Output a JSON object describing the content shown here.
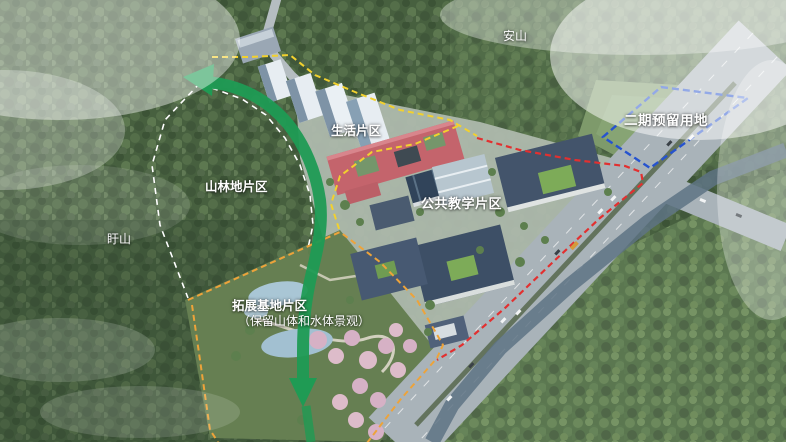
{
  "title": "校园规划鸟瞰图",
  "labels": {
    "anshan": "安山",
    "xushan": "盱山",
    "phase2": "二期预留用地",
    "living": "生活片区",
    "forest_zone": "山林地片区",
    "teaching": "公共教学片区",
    "expansion": "拓展基地片区",
    "expansion_note": "（保留山体和水体景观）"
  },
  "colors": {
    "phase2_boundary": "#2653cf",
    "campus_boundary": "#e23030",
    "zone_divider_yellow": "#f2d12e",
    "expansion_boundary": "#eda33a",
    "forest_zone_boundary": "#ffffff",
    "green_axis": "#1f9b54"
  }
}
